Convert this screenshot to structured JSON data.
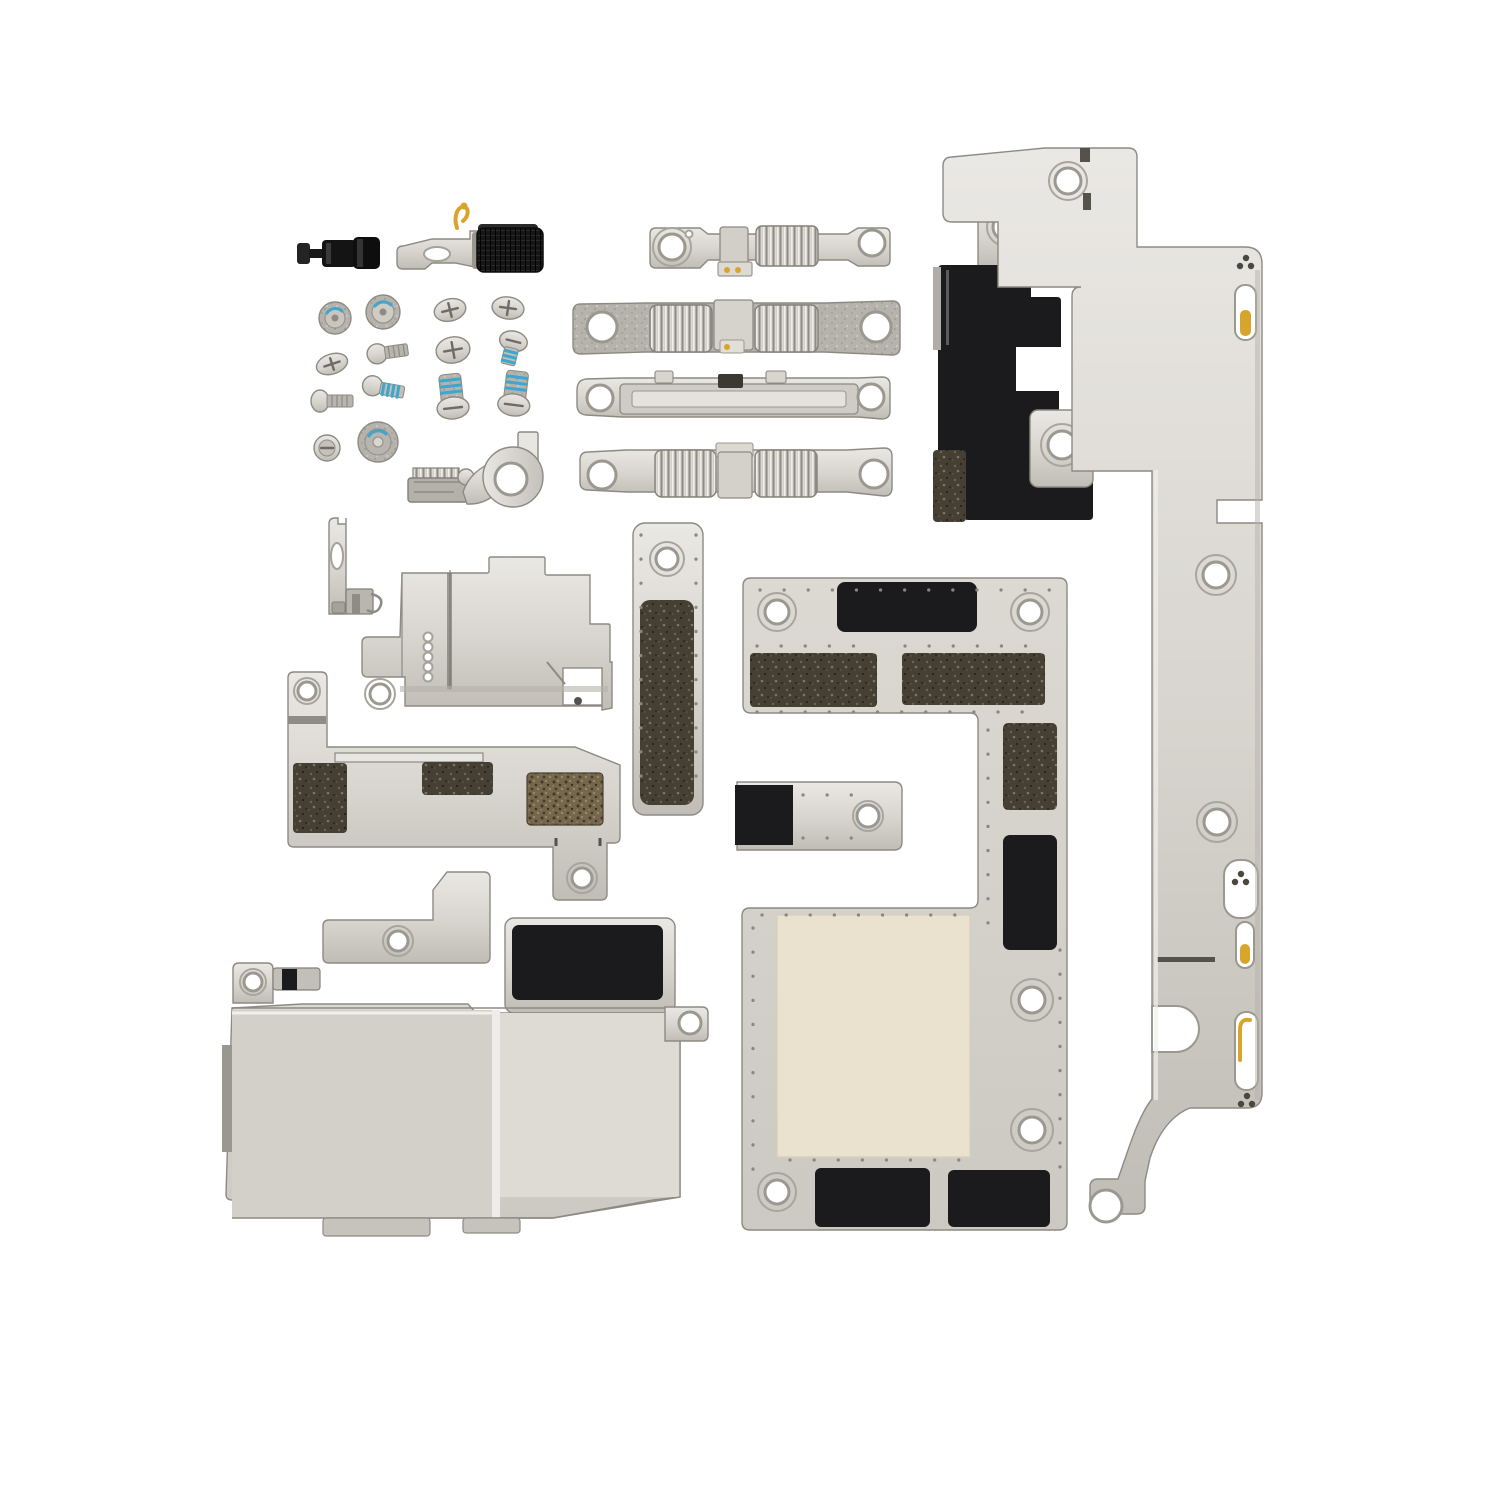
{
  "scene": {
    "type": "product-photo",
    "subject": "iPhone interior small parts set - metal brackets, shields and screws on white background",
    "parts": [
      {
        "name": "black-standoff-plunger",
        "finish": "black"
      },
      {
        "name": "spring-contact-bracket",
        "finish": "metal with gold spring and black mesh roller"
      },
      {
        "name": "screw-set",
        "count": 14,
        "note": "phillips screws, several with blue threadlock"
      },
      {
        "name": "contact-clip",
        "finish": "metal"
      },
      {
        "name": "eyelet-bracket",
        "finish": "metal, large round hole"
      },
      {
        "name": "cable-clamp-bracket",
        "count": 4,
        "finish": "metal dog-bone clamps with ribbed rollers"
      },
      {
        "name": "black-camera-holder-bracket",
        "finish": "black with two metal eyelet tabs"
      },
      {
        "name": "side-rail-long-bracket",
        "finish": "metal, full-height right rail with gold contacts"
      },
      {
        "name": "key-shaped-bracket",
        "finish": "metal"
      },
      {
        "name": "flex-cover-bracket",
        "finish": "metal with five contact eyelets"
      },
      {
        "name": "vertical-pad-strip-bracket",
        "finish": "metal with long black pad"
      },
      {
        "name": "foam-padded-bracket",
        "finish": "metal with dark foam pads"
      },
      {
        "name": "l-shaped-logic-board-shield",
        "finish": "metal with black adhesive pads and cream inlay"
      },
      {
        "name": "padded-arm-bracket",
        "finish": "metal with black pad"
      },
      {
        "name": "small-l-bracket",
        "finish": "metal"
      },
      {
        "name": "speaker-shield-plate",
        "finish": "two-panel metal cover with black pad"
      }
    ]
  },
  "colors": {
    "bg": "#ffffff",
    "white": "#ffffff",
    "metal": "#d8d5cf",
    "metalDark": "#96938c",
    "black": "#1b1b1d",
    "blackSoft": "#242426",
    "foamDark": "#453f34",
    "foamBrown": "#75674c",
    "cream": "#eae1cf",
    "blue": "#3fa6cd",
    "gold": "#d7a52c"
  }
}
